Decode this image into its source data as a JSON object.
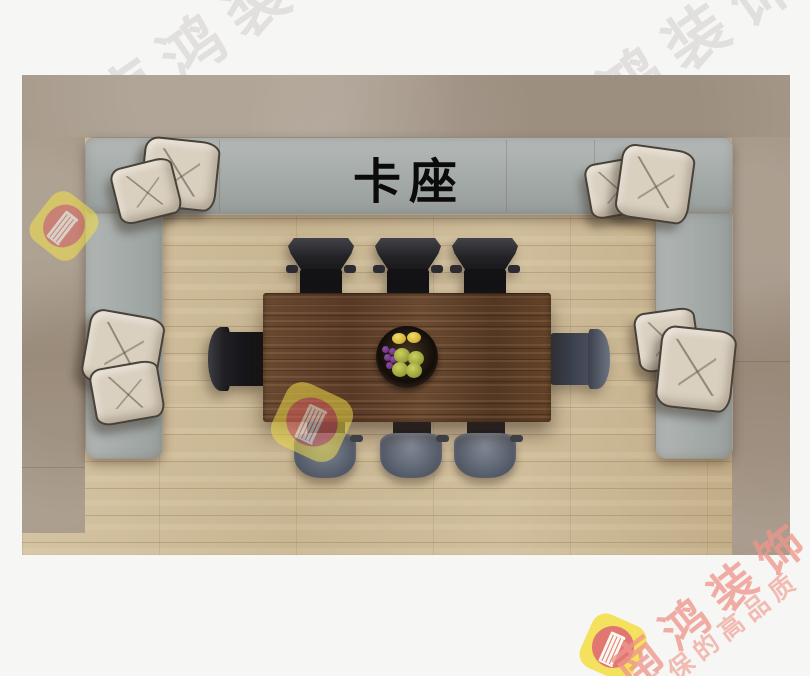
{
  "scene": {
    "title": "卡座",
    "description_label": "booth-seating-top-view",
    "object_counts": {
      "chairs": 8,
      "pillows": 8,
      "tables": 1,
      "fruit_plates": 1,
      "bench_sections": 3
    },
    "colors": {
      "page_background": "#f6f6f4",
      "stone_border": "#a89b8c",
      "wood_floor": "#ccba97",
      "bench_gray": "#a7adab",
      "table_wood": "#5e402b",
      "pillow_beige": "#d9d0c0",
      "chair_dark": "#232327",
      "chair_seat_slate": "#5d6472",
      "title_text": "#0b0b0b",
      "watermark_red": "#ee968a",
      "logo_yellow": "#f4e04a",
      "logo_red": "#e06660"
    }
  },
  "watermarks": {
    "faint_brand_text": "南鸿装饰",
    "brand_text": "南鸿装饰",
    "slogan_text": "环保的高品质",
    "logo_name": "nanhong-column-logo"
  }
}
